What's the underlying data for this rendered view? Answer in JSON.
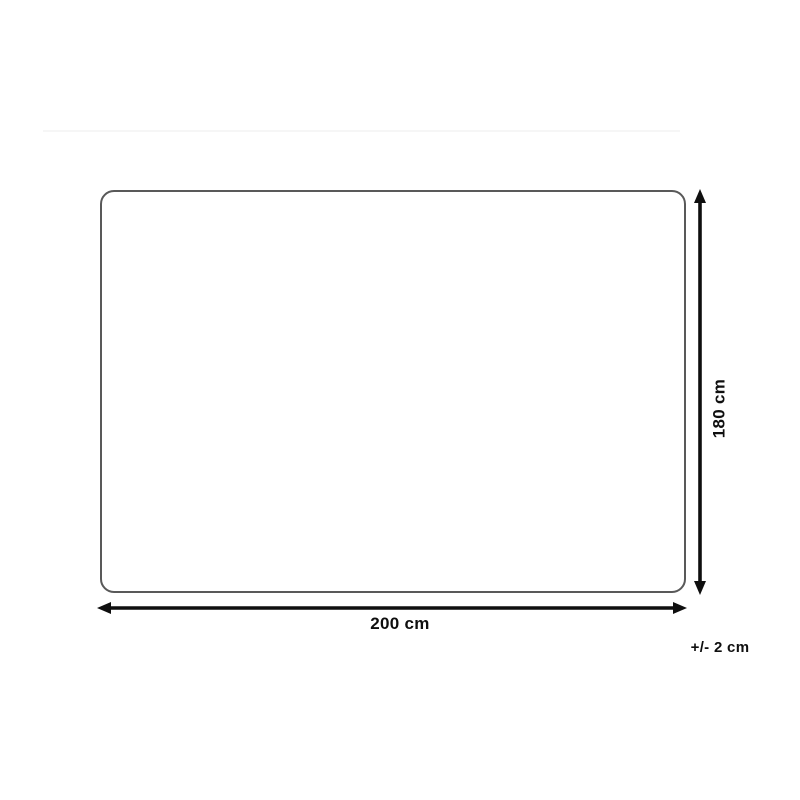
{
  "diagram": {
    "labels": {
      "width": "200 cm",
      "height": "180 cm",
      "tolerance": "+/- 2 cm"
    },
    "colors": {
      "arrow": "#0f0f0f",
      "outline": "#595959",
      "background": "#ffffff",
      "divider": "#f6f6f6"
    },
    "icons": {
      "horizontal_arrow": "double-headed-arrow-horizontal",
      "vertical_arrow": "double-headed-arrow-vertical"
    }
  }
}
